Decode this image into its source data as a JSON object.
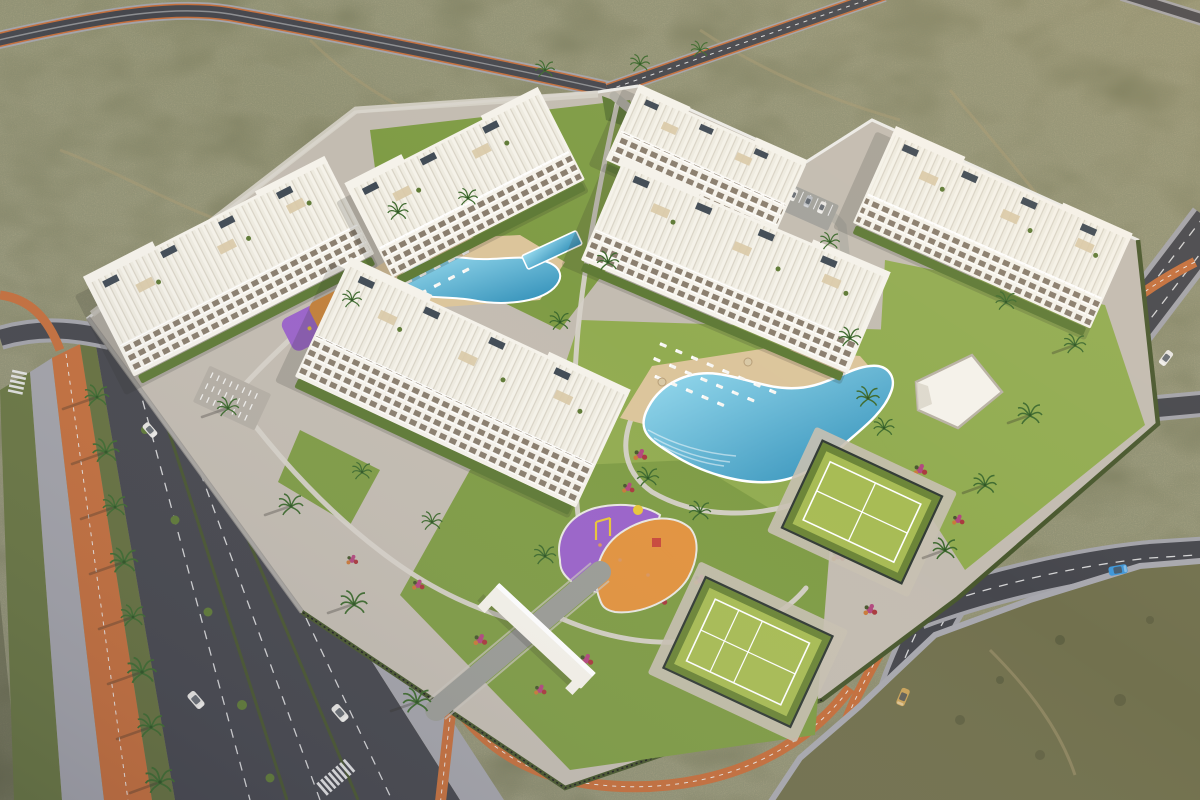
{
  "scene": {
    "type": "aerial-3d-architectural-render",
    "subject": "gated residential apartment complex with amenities",
    "surroundings": "desert scrubland with dirt trails",
    "lighting": "warm low-sun evening light, shadows cast to the southwest"
  },
  "colors": {
    "desertBase": "#72714e",
    "desertDark": "#55583c",
    "desertLight": "#8c8562",
    "trail": "#a89a72",
    "asphalt": "#46474d",
    "asphaltDark": "#3b3c42",
    "sidewalk": "#a3a3a9",
    "paving": "#c3bcb1",
    "pathLight": "#d6d1c8",
    "bikeLane": "#c46f3c",
    "laneLine": "#ececec",
    "building": "#f5f2ea",
    "roofDeck": "#edeade",
    "windowGlass": "#8a7e6e",
    "awning": "#d9c9a6",
    "solar": "#414b55",
    "lawn": "#7f9c45",
    "lawnDark": "#5f7a36",
    "lawnLight": "#92ac51",
    "hedge": "#49582e",
    "pool": "#3e9dc2",
    "poolLight": "#9adcef",
    "poolDeep": "#2d8cb6",
    "deck": "#dcc59b",
    "courtGreen": "#a8bc55",
    "courtDark": "#6c8538",
    "fence": "#333c36",
    "playPurple": "#9a63c9",
    "playOrange": "#e2933f",
    "playYellow": "#e8c53a",
    "playRed": "#c94a3c",
    "flowerMagenta": "#b2487e",
    "flowerRed": "#a93a3e",
    "flowerOrange": "#c97a3a",
    "palm": "#3f6b2f",
    "carWhite": "#e8e6e2",
    "carBlue": "#3f97d8",
    "carGold": "#c9a35a",
    "carSilver": "#b9bcc0",
    "shadow": "#2e2b25"
  },
  "inventory": {
    "apartment_buildings": 6,
    "building_features": [
      "rooftop terraces",
      "pergolas",
      "solar panels",
      "tiered balconies",
      "private gardens"
    ],
    "swimming_pools": [
      "curved-pool-northwest",
      "lap-pool-northwest",
      "lagoon-pool-central"
    ],
    "sports_courts": [
      "padel-court",
      "tennis-court"
    ],
    "playgrounds": [
      "central-playground",
      "west-playground"
    ],
    "amenities": [
      "entrance-gate",
      "bike-parking",
      "car-parking",
      "clubhouse",
      "sun-loungers",
      "palm-trees"
    ],
    "roads": [
      "north-road",
      "west-boulevard",
      "east-road",
      "loop-road",
      "orange-bike-lanes"
    ],
    "crosswalks": 3,
    "vehicles": [
      {
        "color": "white",
        "location": "boulevard-north"
      },
      {
        "color": "white",
        "location": "boulevard-center"
      },
      {
        "color": "white",
        "location": "boulevard-south"
      },
      {
        "color": "white",
        "location": "east-road-north"
      },
      {
        "color": "beige",
        "location": "east-road-south"
      },
      {
        "color": "blue",
        "location": "loop-road"
      },
      {
        "color": "white",
        "location": "internal-parking"
      },
      {
        "color": "silver",
        "location": "internal-parking"
      }
    ]
  }
}
